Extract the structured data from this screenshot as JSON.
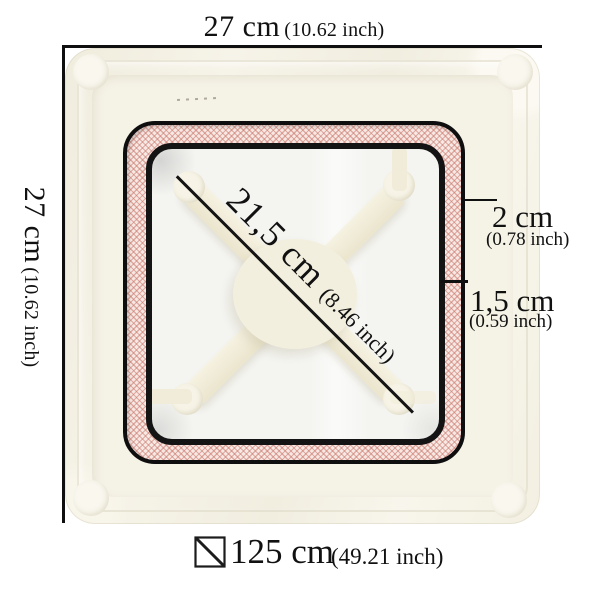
{
  "dimensions": {
    "top": {
      "metric": "27 cm",
      "imperial": "(10.62 inch)"
    },
    "left": {
      "metric": "27 cm",
      "imperial": "(10.62 inch)"
    },
    "diagonal": {
      "metric": "21,5 cm",
      "imperial": "(8.46 inch)"
    },
    "gasket_width": {
      "metric": "2 cm",
      "imperial": "(0.78 inch)"
    },
    "frame_thickness": {
      "metric": "1,5 cm",
      "imperial": "(0.59 inch)"
    },
    "perimeter": {
      "metric": "125 cm",
      "imperial": "(49.21 inch)"
    }
  },
  "icons": {
    "perimeter_icon": "square-with-diagonal-line"
  },
  "colors": {
    "dimension_line": "#0f0f0f",
    "tray_cream": "#f3f0e2",
    "gasket_pink_base": "#f8e8e4",
    "gasket_hatch": "#c8766a",
    "inner_panel": "#f4f4f1",
    "background": "#ffffff"
  }
}
